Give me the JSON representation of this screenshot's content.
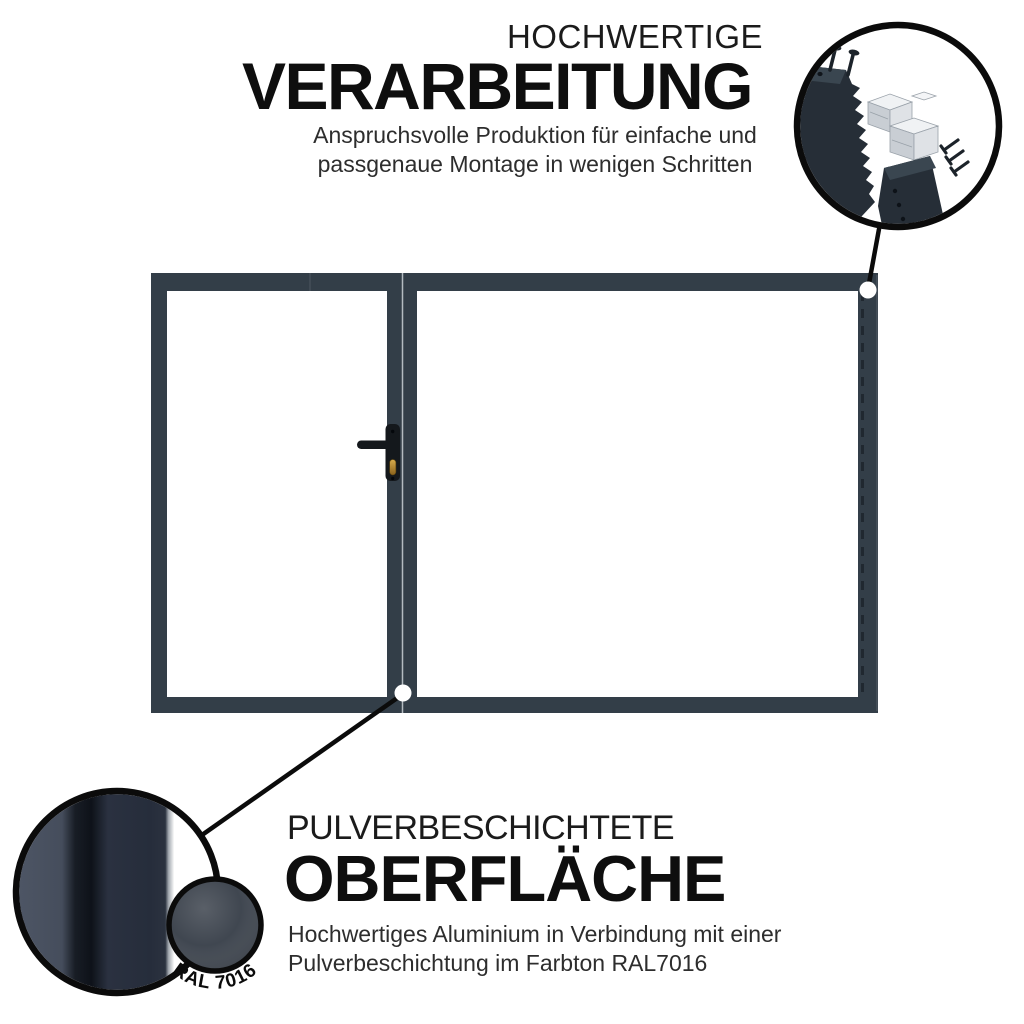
{
  "canvas": {
    "width": 1024,
    "height": 1024,
    "background": "#FFFFFF"
  },
  "colors": {
    "frame": "#333E48",
    "frame_seam_light": "#C3C9CF",
    "frame_dash": "#1F262E",
    "frame_edge_highlight": "#525C66",
    "handle": "#14181C",
    "keyhole_brass": "#C1902F",
    "detail_outline": "#0B0B0B",
    "callout_line": "#0B0B0B",
    "anchor_dot": "#FFFFFF",
    "swatch_ral7016": "#3A414B",
    "profile_dark": "#262E37",
    "profile_top_face": "#3A4650",
    "connector_light": "#F0F2F4",
    "title_text": "#0E0E0E",
    "eyebrow_text": "#1B1B1B",
    "body_text": "#2D2D2D"
  },
  "callouts": {
    "top": {
      "eyebrow": "HOCHWERTIGE",
      "title": "VERARBEITUNG",
      "desc_line1": "Anspruchsvolle Produktion für einfache und",
      "desc_line2": "passgenaue Montage in wenigen Schritten",
      "detail_icon": "corner-assembly-exploded-view"
    },
    "bottom": {
      "eyebrow": "PULVERBESCHICHTETE",
      "title": "OBERFLÄCHE",
      "desc_line1": "Hochwertiges Aluminium in Verbindung mit einer",
      "desc_line2": "Pulverbeschichtung im Farbton RAL7016",
      "swatch_label": "RAL 7016",
      "detail_icon": "powder-coated-profile-cross-section"
    }
  }
}
